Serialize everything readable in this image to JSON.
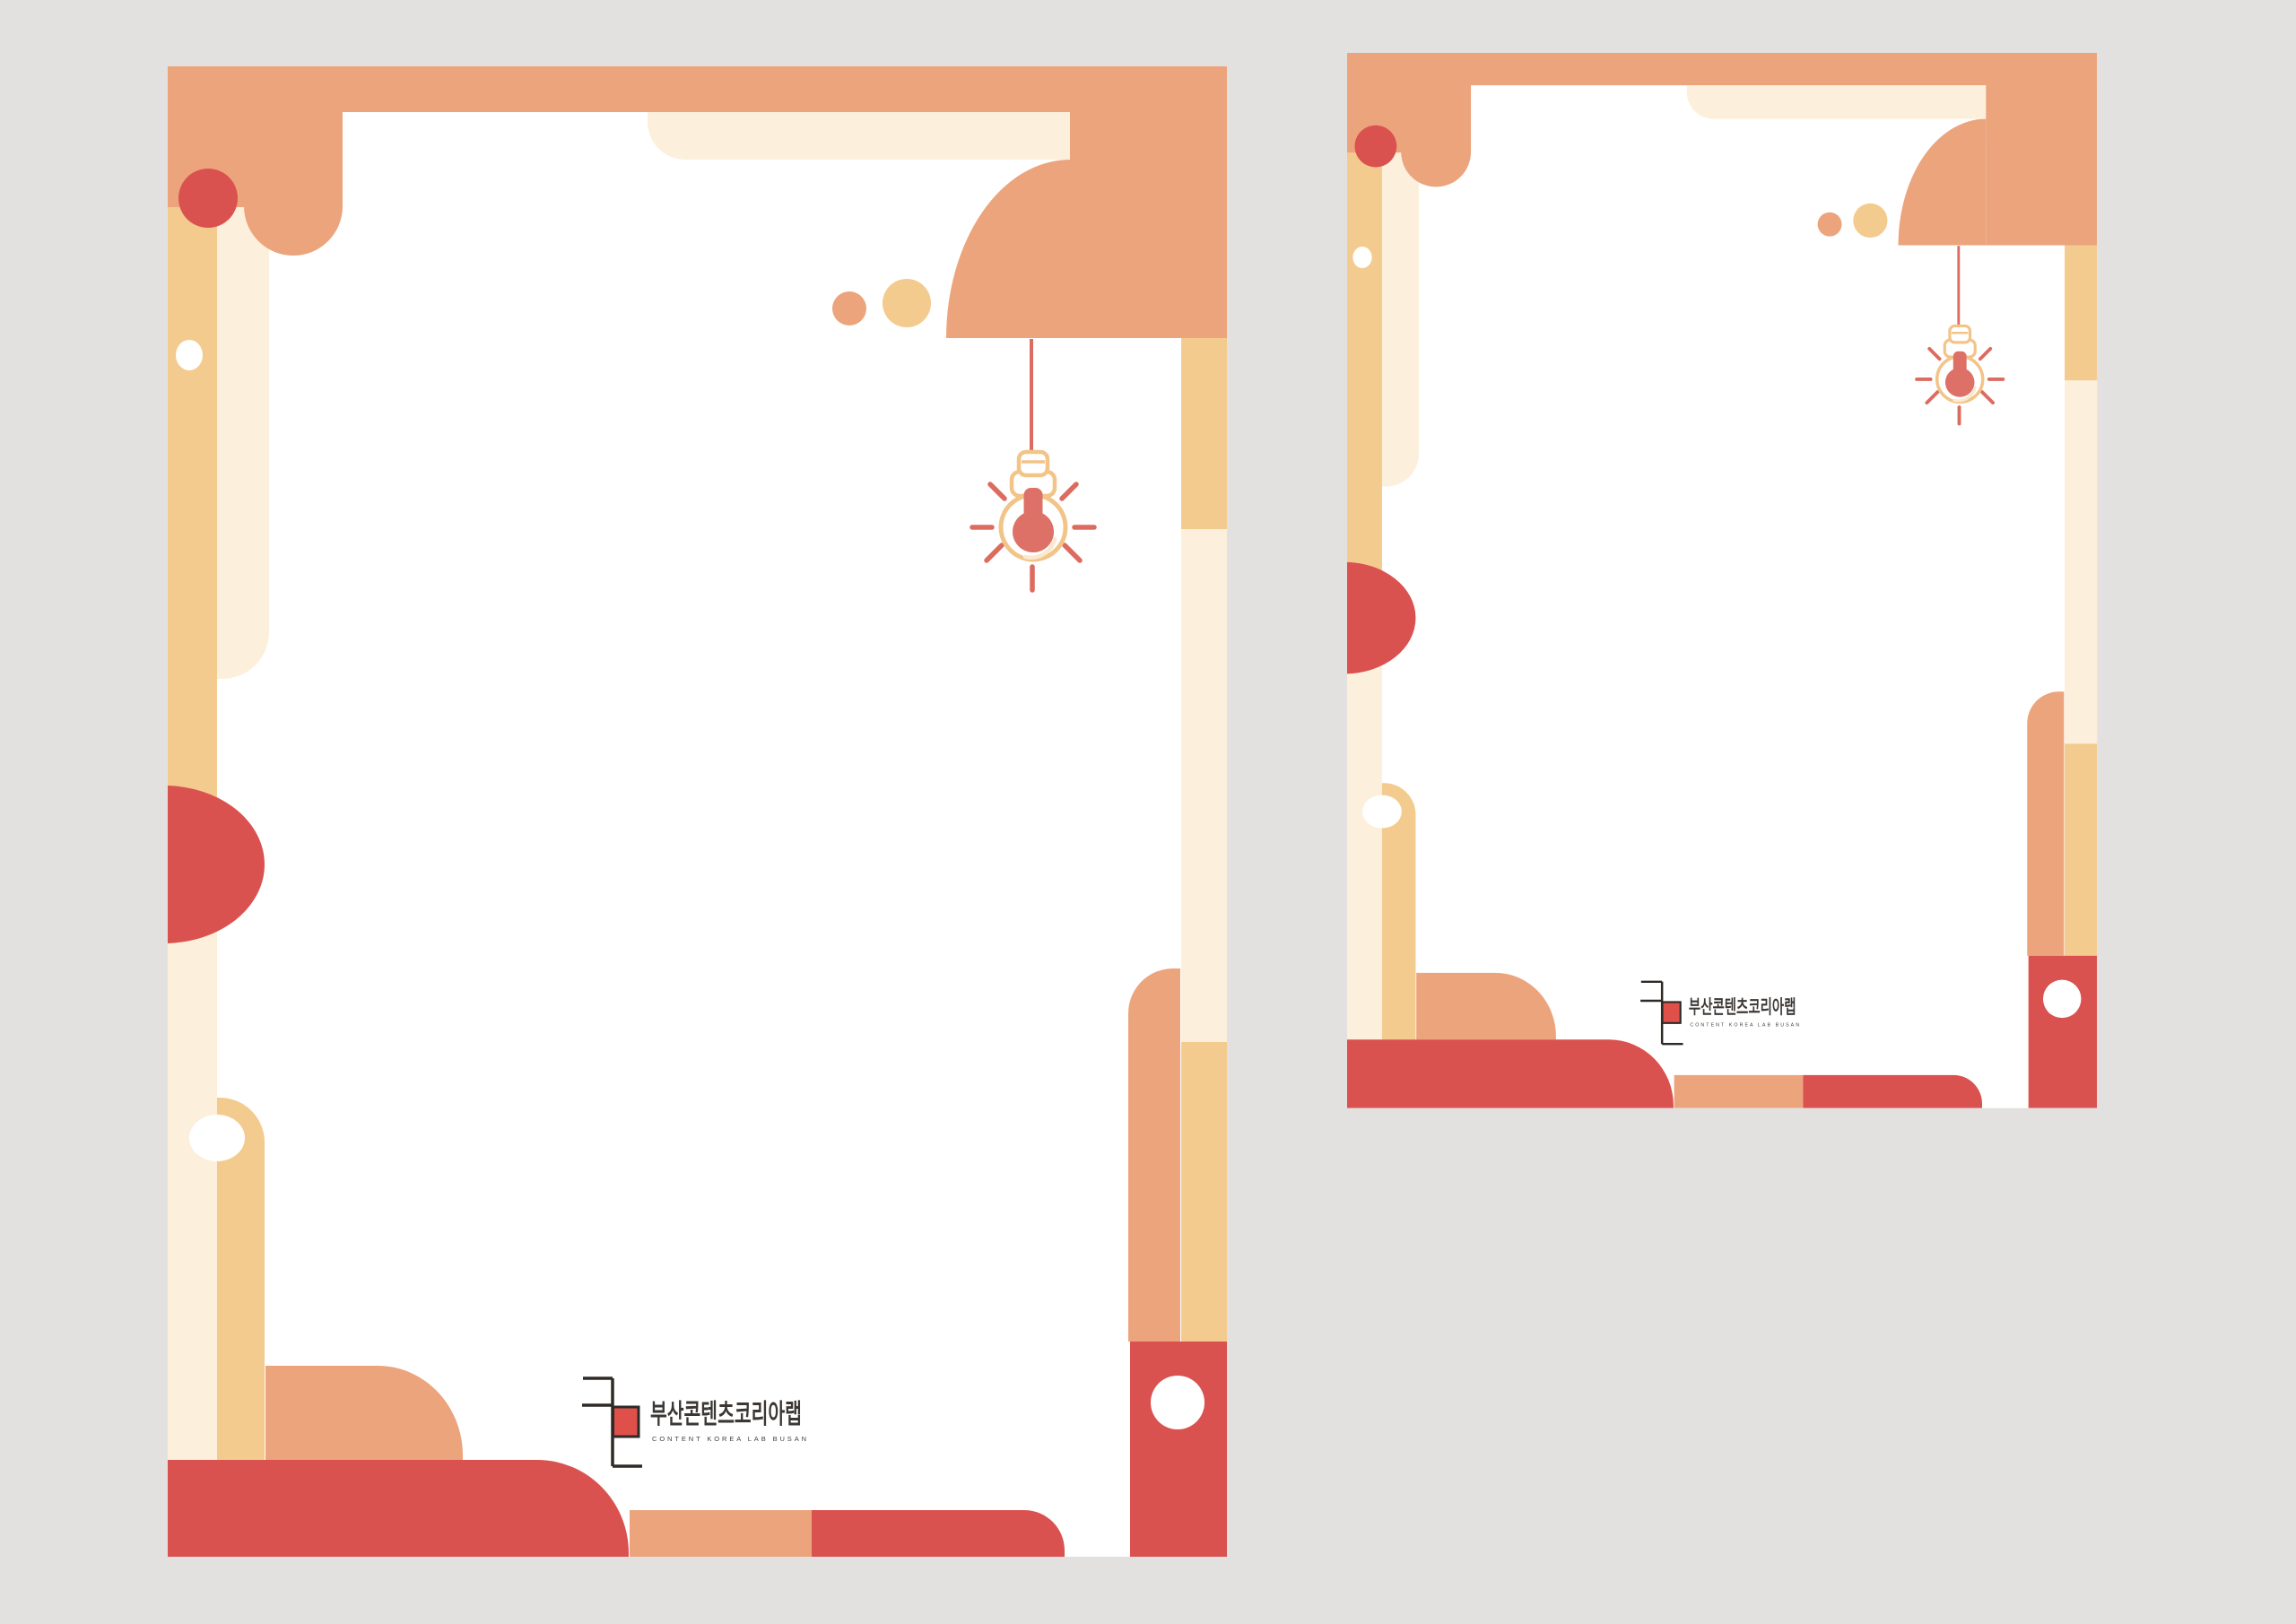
{
  "page": {
    "background_color": "#E2E1E0"
  },
  "palette": {
    "gray": "#E2E1E0",
    "salmon": "#ECA47D",
    "tan": "#F4CB8E",
    "cream": "#FCF0DC",
    "red": "#DA524F",
    "ray": "#DC6B60",
    "filament": "#DD7067",
    "bulbline": "#F2C488",
    "highlight": "#FAE8CF",
    "ink": "#2E2A27",
    "logored": "#E0504B",
    "kr": "#3B3734",
    "en": "#45413E"
  },
  "poster": {
    "logo": {
      "korean_title": "부산콘텐츠코리아랩",
      "english_subtitle": "CONTENT KOREA LAB BUSAN",
      "mark_square_color": "#E0504B"
    },
    "icons": {
      "hanging_lightbulb": "lightbulb-icon"
    }
  }
}
